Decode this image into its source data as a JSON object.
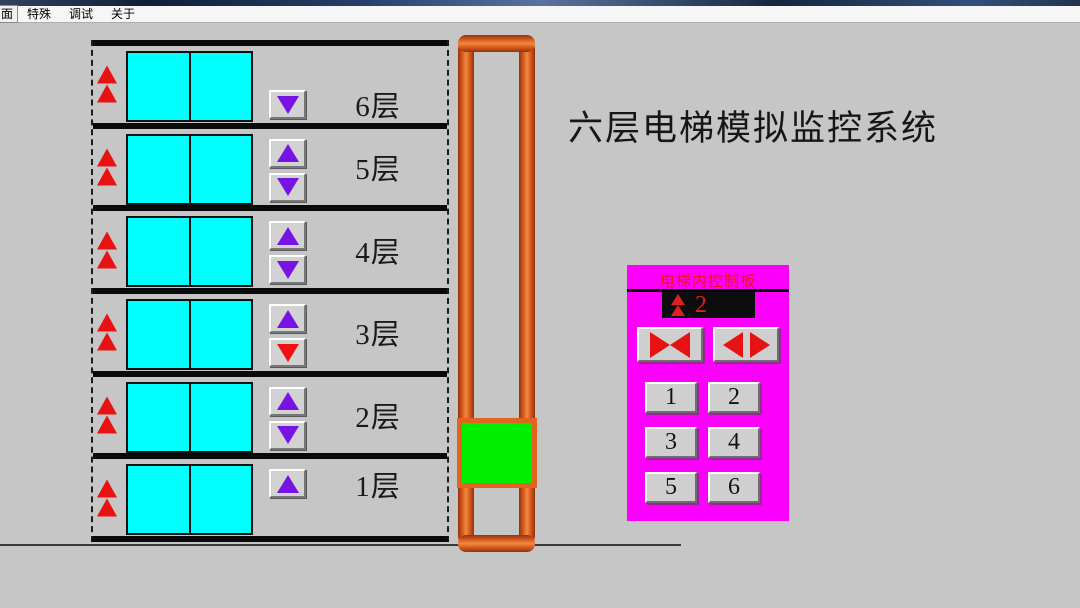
{
  "menu_bar": {
    "items": [
      {
        "label": "面",
        "boxed": true
      },
      {
        "label": "特殊",
        "boxed": false
      },
      {
        "label": "调试",
        "boxed": false
      },
      {
        "label": "关于",
        "boxed": false
      }
    ]
  },
  "main_title": "六层电梯模拟监控系统",
  "building": {
    "floors": [
      {
        "floor": 6,
        "label": "6层",
        "has_up": false,
        "has_down": true,
        "up_active": false,
        "down_active": false
      },
      {
        "floor": 5,
        "label": "5层",
        "has_up": true,
        "has_down": true,
        "up_active": false,
        "down_active": false
      },
      {
        "floor": 4,
        "label": "4层",
        "has_up": true,
        "has_down": true,
        "up_active": false,
        "down_active": false
      },
      {
        "floor": 3,
        "label": "3层",
        "has_up": true,
        "has_down": true,
        "up_active": false,
        "down_active": true
      },
      {
        "floor": 2,
        "label": "2层",
        "has_up": true,
        "has_down": true,
        "up_active": false,
        "down_active": false
      },
      {
        "floor": 1,
        "label": "1层",
        "has_up": true,
        "has_down": false,
        "up_active": false,
        "down_active": false
      }
    ],
    "indicator_icon": "double-up-arrow"
  },
  "elevator": {
    "car_position_floor": "2",
    "car_color": "#00ee00",
    "shaft_color": "#e0661c"
  },
  "control_panel": {
    "title": "电梯内控制板",
    "display": {
      "value": "2",
      "direction": "up",
      "direction_icon": "double-up-arrow"
    },
    "door_buttons": [
      {
        "name": "close-door",
        "icon": "door-close-icon"
      },
      {
        "name": "open-door",
        "icon": "door-open-icon"
      }
    ],
    "floor_buttons": [
      "1",
      "2",
      "3",
      "4",
      "5",
      "6"
    ]
  },
  "colors": {
    "background": "#c6c6c6",
    "door_cyan": "#00ffff",
    "car_green": "#00ee00",
    "shaft_orange": "#e0661c",
    "panel_magenta": "#fb00fb",
    "indicator_red": "#ee1111",
    "button_purple": "#7714e4",
    "display_red": "#d42222"
  }
}
